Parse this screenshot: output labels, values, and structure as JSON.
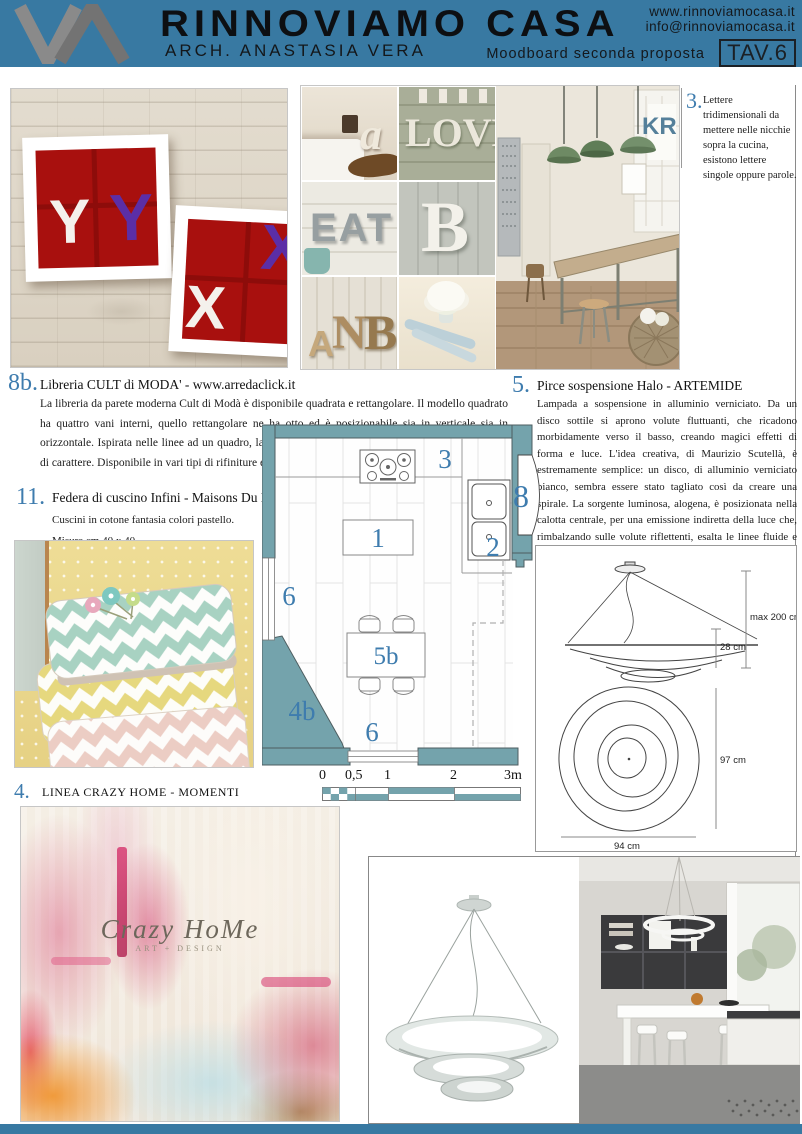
{
  "colors": {
    "header_bg": "#3879a2",
    "accent_blue": "#3e7cae",
    "plan_wall_teal": "#74a3ac",
    "shelf_red": "#a8100e",
    "logo_gray": "#7c7c7c"
  },
  "header": {
    "title": "RINNOVIAMO CASA",
    "subtitle": "ARCH. ANASTASIA VERA",
    "website": "www.rinnoviamocasa.it",
    "email": "info@rinnoviamocasa.it",
    "board_label": "Moodboard seconda proposta",
    "tav": "TAV.6"
  },
  "item3": {
    "number": "3.",
    "text": "Lettere tridimensionali da mettere nelle nicchie sopra la cucina, esistono lettere singole oppure parole."
  },
  "item8b": {
    "number": "8b.",
    "title": "Libreria CULT di MODA' - www.arredaclick.it",
    "body": "La libreria da parete moderna Cult di Modà è disponibile quadrata e rettangolare. Il modello quadrato ha quattro vani interni, quello rettangolare ne ha otto ed è posizionabile sia in verticale sia in orizzontale. Ispirata nelle linee ad un quadro, la libreria Cult è un complemento d'arredo originale e di carattere. Disponibile in vari tipi di rifiniture e colori."
  },
  "item5": {
    "number": "5.",
    "title": "Pirce sospensione Halo - ARTEMIDE",
    "body": "Lampada a sospensione in alluminio verniciato. Da un disco sottile si aprono volute fluttuanti, che ricadono morbidamente verso il basso, creando magici effetti di forma e luce.  L'idea creativa, di Maurizio Scutellà, è estremamente semplice: un disco, di alluminio verniciato bianco, sembra essere stato tagliato così da creare una spirale. La sorgente luminosa, alogena, è posizionata nella calotta centrale, per una emissione indiretta della luce che, rimbalzando sulle volute riflettenti, esalta le linee fluide e gli effetti chiaroscurali della struttura. Disponibile in tre versioni, grande, media, mini, Pirce sospensione di Artemide veste grandi spazi creando visioni differenti da ogni punto di osservazione."
  },
  "item11": {
    "number": "11.",
    "title": "Federa di cuscino Infini  - Maisons Du Monde",
    "body": "Cuscini in cotone fantasia colori pastello. Misure cm 40 x 40."
  },
  "item4": {
    "number": "4.",
    "title": "LINEA CRAZY HOME - MOMENTI"
  },
  "plan": {
    "n1": "1",
    "n2": "2",
    "n3": "3",
    "n5b": "5b",
    "n6_left": "6",
    "n6_bottom": "6",
    "n4b": "4b",
    "n8": "8"
  },
  "scale": {
    "t0": "0",
    "t05": "0,5",
    "t1": "1",
    "t2": "2",
    "t3": "3m"
  },
  "lampdims": {
    "max": "max 200 cm",
    "h": "28 cm",
    "d1": "97 cm",
    "d2": "94 cm"
  },
  "photos": {
    "letterboxes": {
      "y1": "Y",
      "y2": "Y",
      "x1": "X",
      "x2": "X"
    },
    "collage": {
      "a": "a",
      "love": "LOVE",
      "eat": "EAT",
      "b": "B",
      "anb_a": "A",
      "anb_n": "N",
      "anb_b": "B",
      "kr": "KR"
    },
    "art": {
      "brand": "Crazy HoMe",
      "sub": "ART + DESIGN"
    }
  }
}
